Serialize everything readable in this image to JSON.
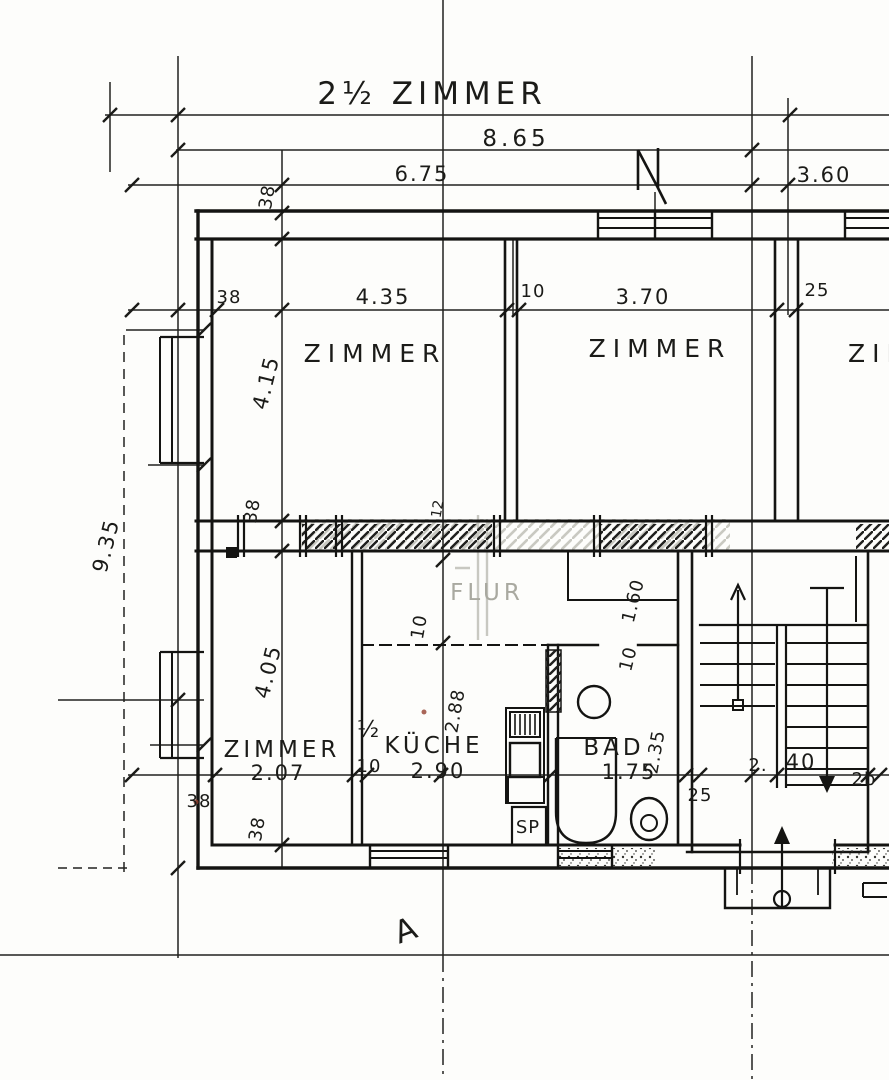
{
  "drawing": {
    "type": "architectural-floor-plan",
    "ink_color": "#1b1b18",
    "faded_color": "#a9a9a0",
    "paper_color": "#fdfdfb"
  },
  "labels": {
    "title": "2½ ZIMMER",
    "dim_total_width": "8.65",
    "dim_width_left": "6.75",
    "dim_width_right": "3.60",
    "dim_wall_top": "38",
    "dim_wall_left": "38",
    "dim_zimmer1_width": "4.35",
    "dim_partition_z12": "10",
    "dim_zimmer2_width": "3.70",
    "dim_wall_z23": "25",
    "room_zimmer1": "ZIMMER",
    "room_zimmer2": "ZIMMER",
    "room_zimmer3": "ZIMMER",
    "dim_zimmer1_depth": "4.15",
    "dim_total_depth": "9.35",
    "dim_wall_mid": "38",
    "dim_wall_mid_small": "12",
    "room_flur": "FLUR",
    "dim_flur_wall": "10",
    "dim_niche_height": "1.60",
    "dim_niche_wall": "10",
    "dim_halfzimmer_depth": "4.05",
    "room_halfzimmer_frac": "½",
    "room_halfzimmer": "ZIMMER",
    "dim_halfzimmer_width": "2.07",
    "room_kueche": "KÜCHE",
    "dim_kueche_width": "2.90",
    "dim_kueche_depth": "2.88",
    "dim_partition_k": "10",
    "room_bad": "BAD",
    "dim_bad_width": "1.75",
    "dim_bad_depth": "2.35",
    "fixture_sp": "SP",
    "dim_stair_wall": "25",
    "dim_stair_a": "2.",
    "dim_stair_b": "40",
    "dim_stair_c": "2b",
    "dim_wall_bottom": "38",
    "dim_wall_bottom_side": "38",
    "section_a": "A"
  }
}
